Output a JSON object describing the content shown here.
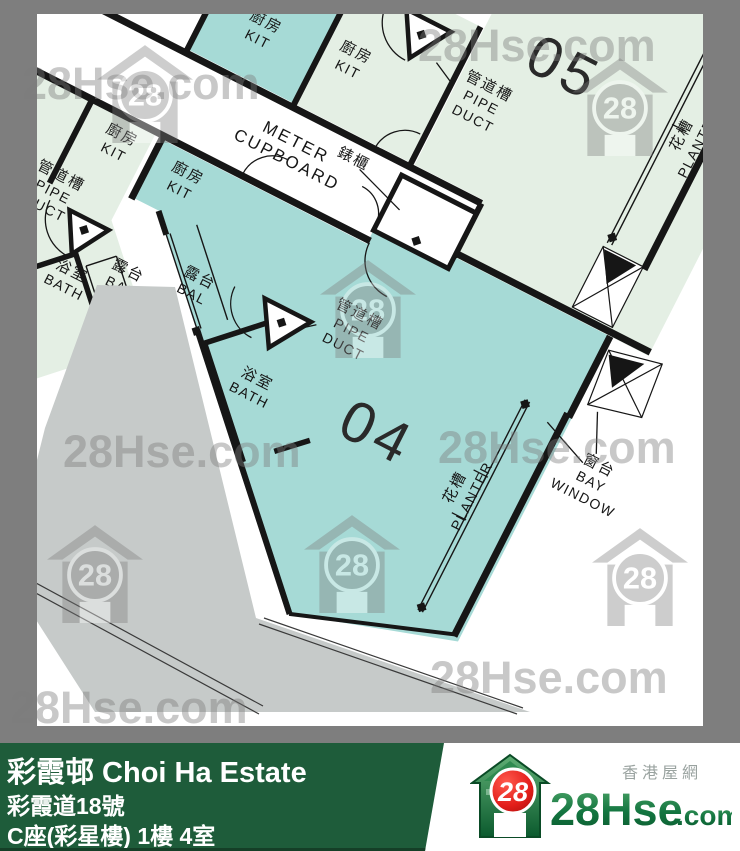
{
  "plan": {
    "units": {
      "unit04": "04",
      "unit05": "05"
    },
    "rooms": {
      "kitchen_zh": "廚房",
      "kitchen_en": "KIT",
      "bath_zh": "浴室",
      "bath_en": "BATH",
      "balcony_zh": "露台",
      "balcony_en": "BAL",
      "pipe_duct_zh": "管道槽",
      "pipe_duct_en_line1": "PIPE",
      "pipe_duct_en_line2": "DUCT",
      "meter_zh": "錶櫃",
      "meter_en_line1": "METER",
      "meter_en_line2": "CUPBOARD",
      "planter_zh": "花槽",
      "planter_en": "PLANTER",
      "bay_window_zh": "窗台",
      "bay_window_en_line1": "BAY",
      "bay_window_en_line2": "WINDOW"
    },
    "colors": {
      "unit_teal": "#a6dad6",
      "unit_pale_green": "#e4efe4",
      "podium_gray": "#c6cac9",
      "wall": "#161616",
      "canvas": "#ffffff",
      "margin_gray": "#7e7e7e"
    }
  },
  "watermark": {
    "text": "28Hse.com",
    "logo_number": "28"
  },
  "footer": {
    "estate_name": "彩霞邨 Choi Ha Estate",
    "address": "彩霞道18號",
    "block_floor_unit": "C座(彩星樓) 1樓 4室",
    "bar_color": "#1e5c3a"
  },
  "brand": {
    "tagline_zh": "香港屋網",
    "logo_number": "28",
    "name_main": "28Hse",
    "name_suffix": ".com"
  }
}
